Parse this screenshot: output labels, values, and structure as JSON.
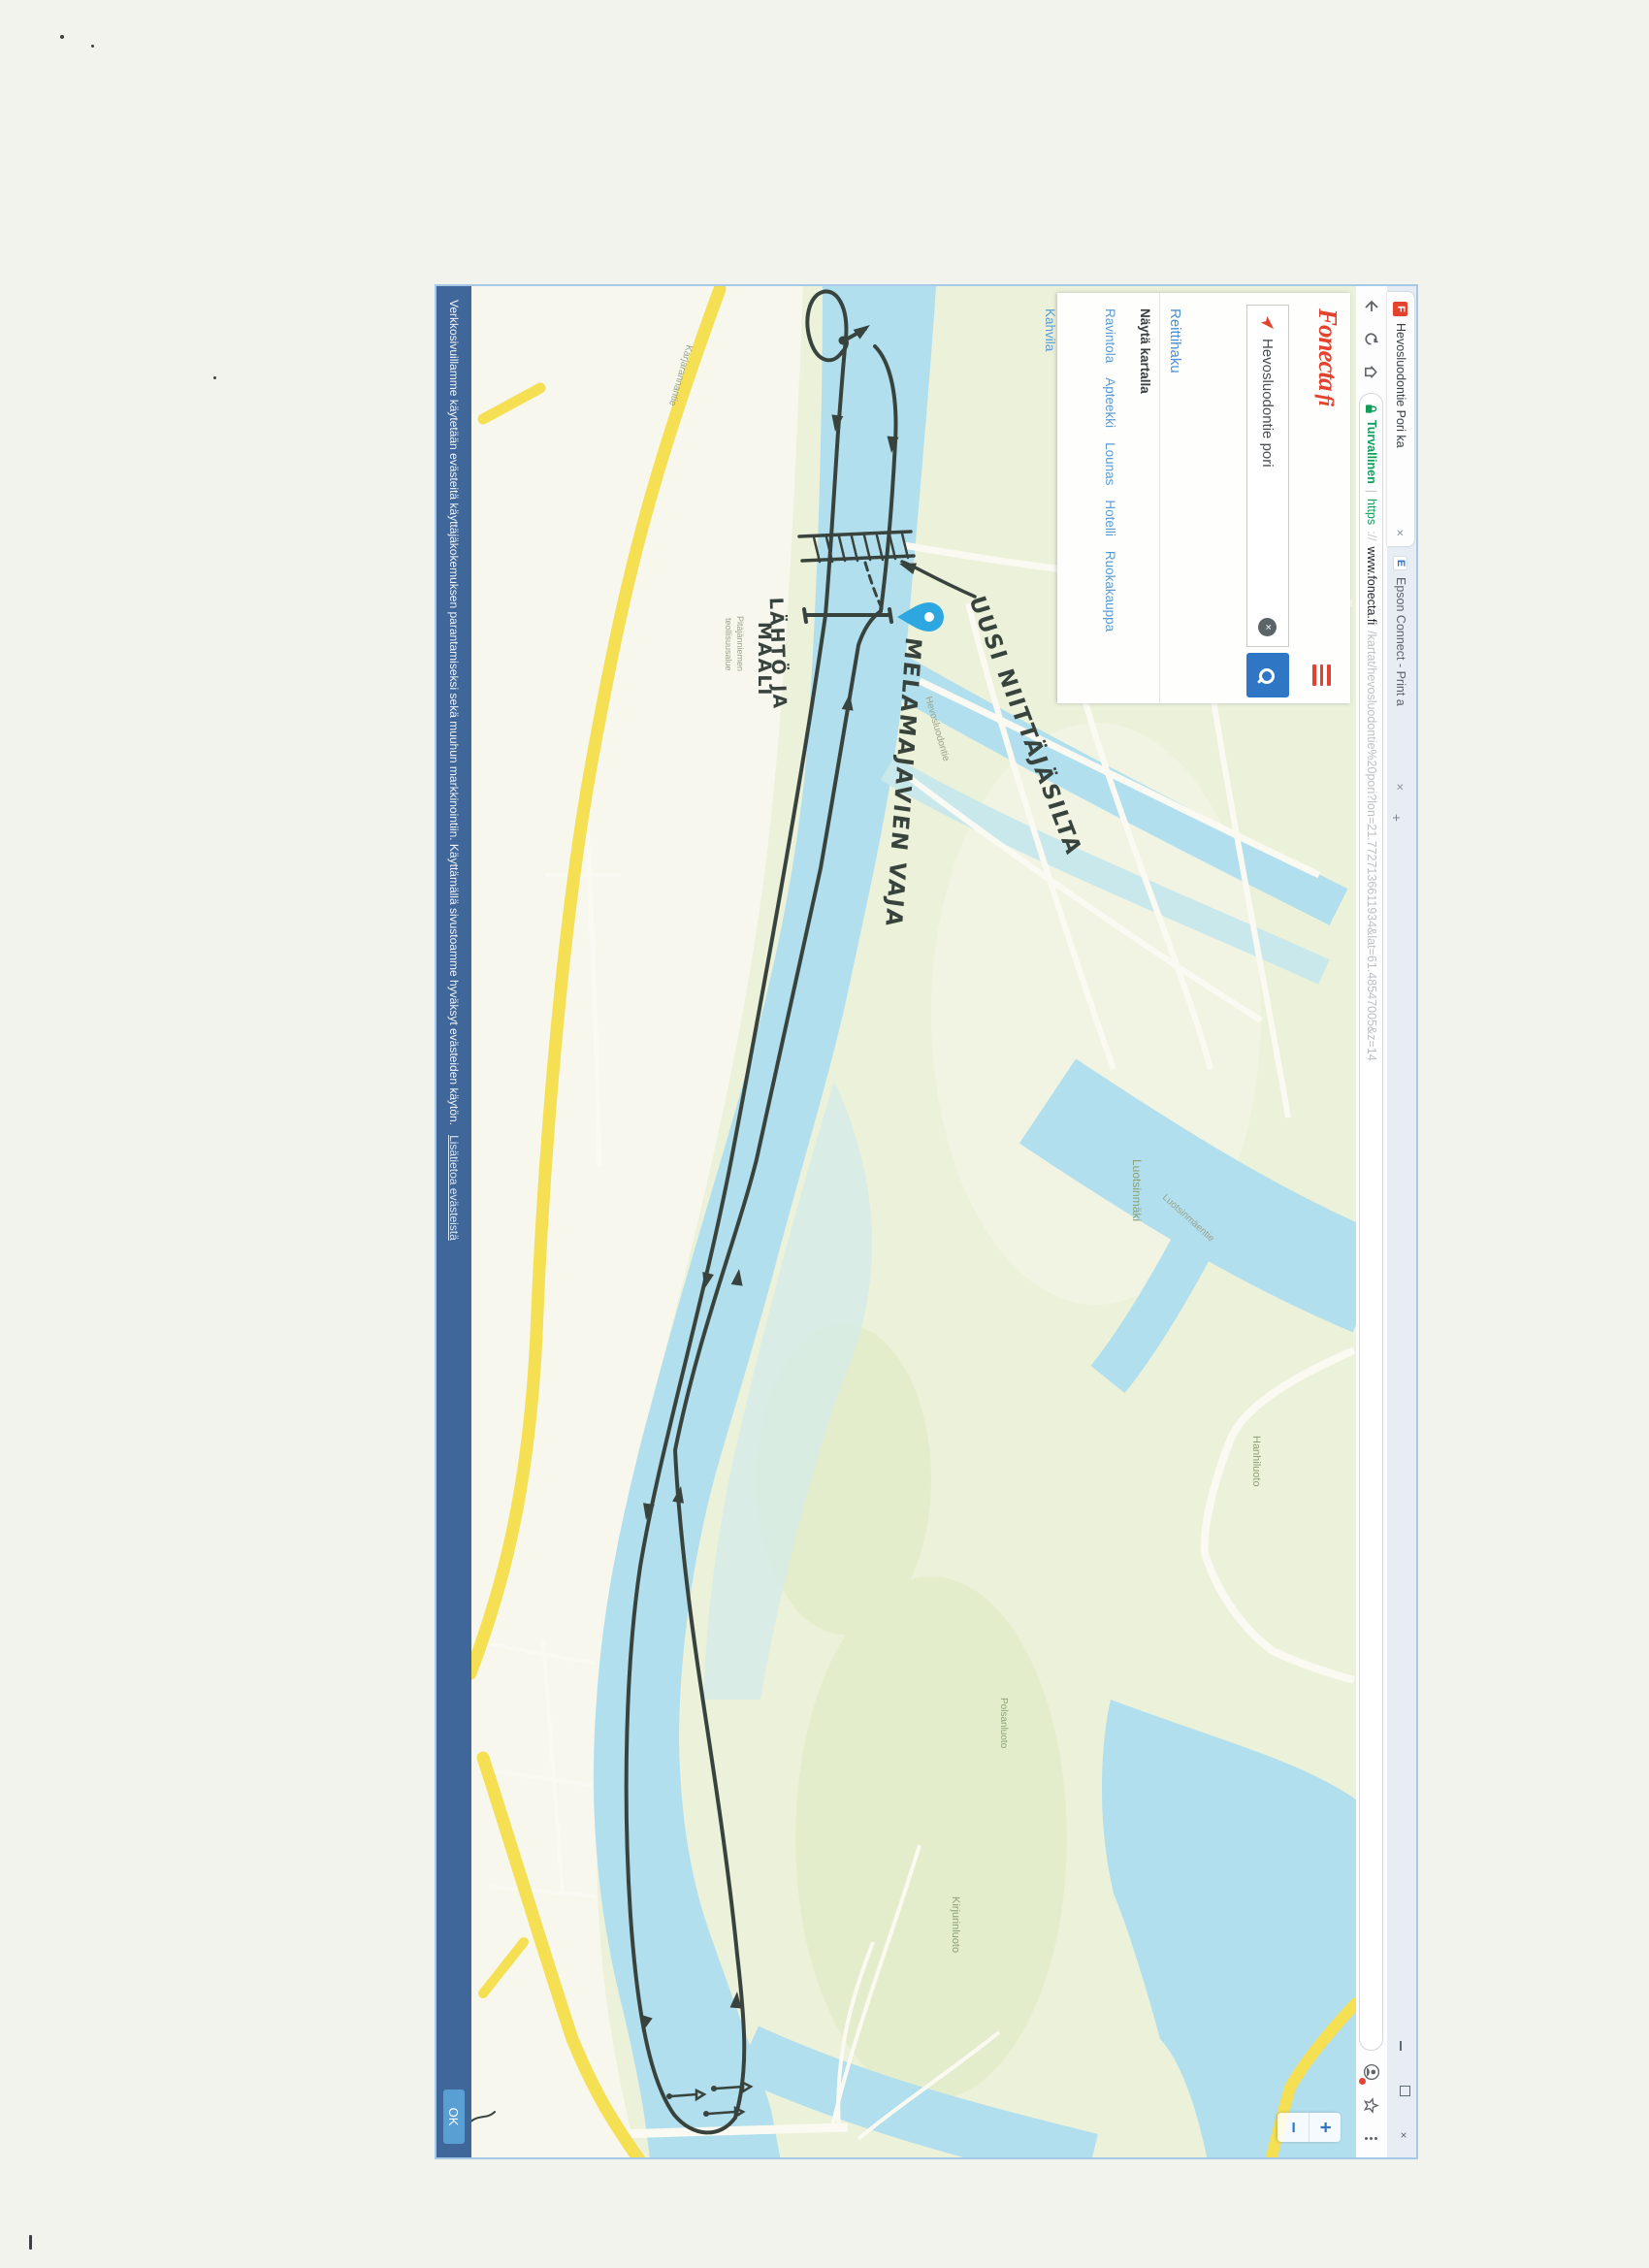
{
  "tabs": [
    {
      "title": "Hevosluodontie Pori ka",
      "close": "×"
    },
    {
      "title": "Epson Connect - Print a",
      "close": "×"
    }
  ],
  "window_controls": {
    "minimize": "",
    "restore": "",
    "close": "×"
  },
  "toolbar": {
    "security": "Turvallinen",
    "scheme": "https",
    "separator": "|",
    "url_prefix": "://",
    "domain": "www.fonecta.fi",
    "path": "/kartat/hevosluodontie%20pori?lon=21.7727136611934&lat=61.48547005&z=14"
  },
  "panel": {
    "logo": "Fonecta",
    "logo_suffix": "fi",
    "search_value": "Hevosluodontie pori",
    "clear": "×",
    "route_link": "Reittihaku",
    "show_on_map": "Näytä kartalla",
    "categories": [
      "Ravintola",
      "Apteekki",
      "Lounas",
      "Hotelli",
      "Ruokakauppa"
    ],
    "categories_row2": [
      "Kahvila"
    ]
  },
  "map": {
    "zoom_in": "+",
    "zoom_out": "−",
    "labels": [
      {
        "text": "Karjarannantie"
      },
      {
        "text": "Pitäjänniemen"
      },
      {
        "text": "teollisuusalue"
      },
      {
        "text": "Hevosluodontie"
      },
      {
        "text": "Luotsinmäentie"
      },
      {
        "text": "Luotsinmäki"
      },
      {
        "text": "Hanhiluoto"
      },
      {
        "text": "Kirjurinluoto"
      },
      {
        "text": "Polsanluoto"
      }
    ]
  },
  "annotations": {
    "start_finish_line1": "LÄHTÖ JA",
    "start_finish_line2": "MAALI",
    "bridge": "UUSI NIITTÄJÄSILTA",
    "shed": "MELAMAJAVIEN VAJA"
  },
  "cookie": {
    "text": "Verkkosivuillamme käytetään evästeitä käyttäjäkokemuksen parantamiseksi sekä muuhun markkinointiin. Käyttämällä sivustoamme hyväksyt evästeiden käytön.",
    "link": "Lisätietoa evästeistä",
    "ok": "OK"
  },
  "colors": {
    "fonecta_red": "#e3432e",
    "search_blue": "#2f77c5",
    "river_blue": "#b2dfee",
    "road_yellow": "#f5df52",
    "cookie_blue": "#40679a",
    "secure_green": "#0f9d58",
    "pen": "#39433d",
    "pin_blue": "#2ea7e0"
  }
}
